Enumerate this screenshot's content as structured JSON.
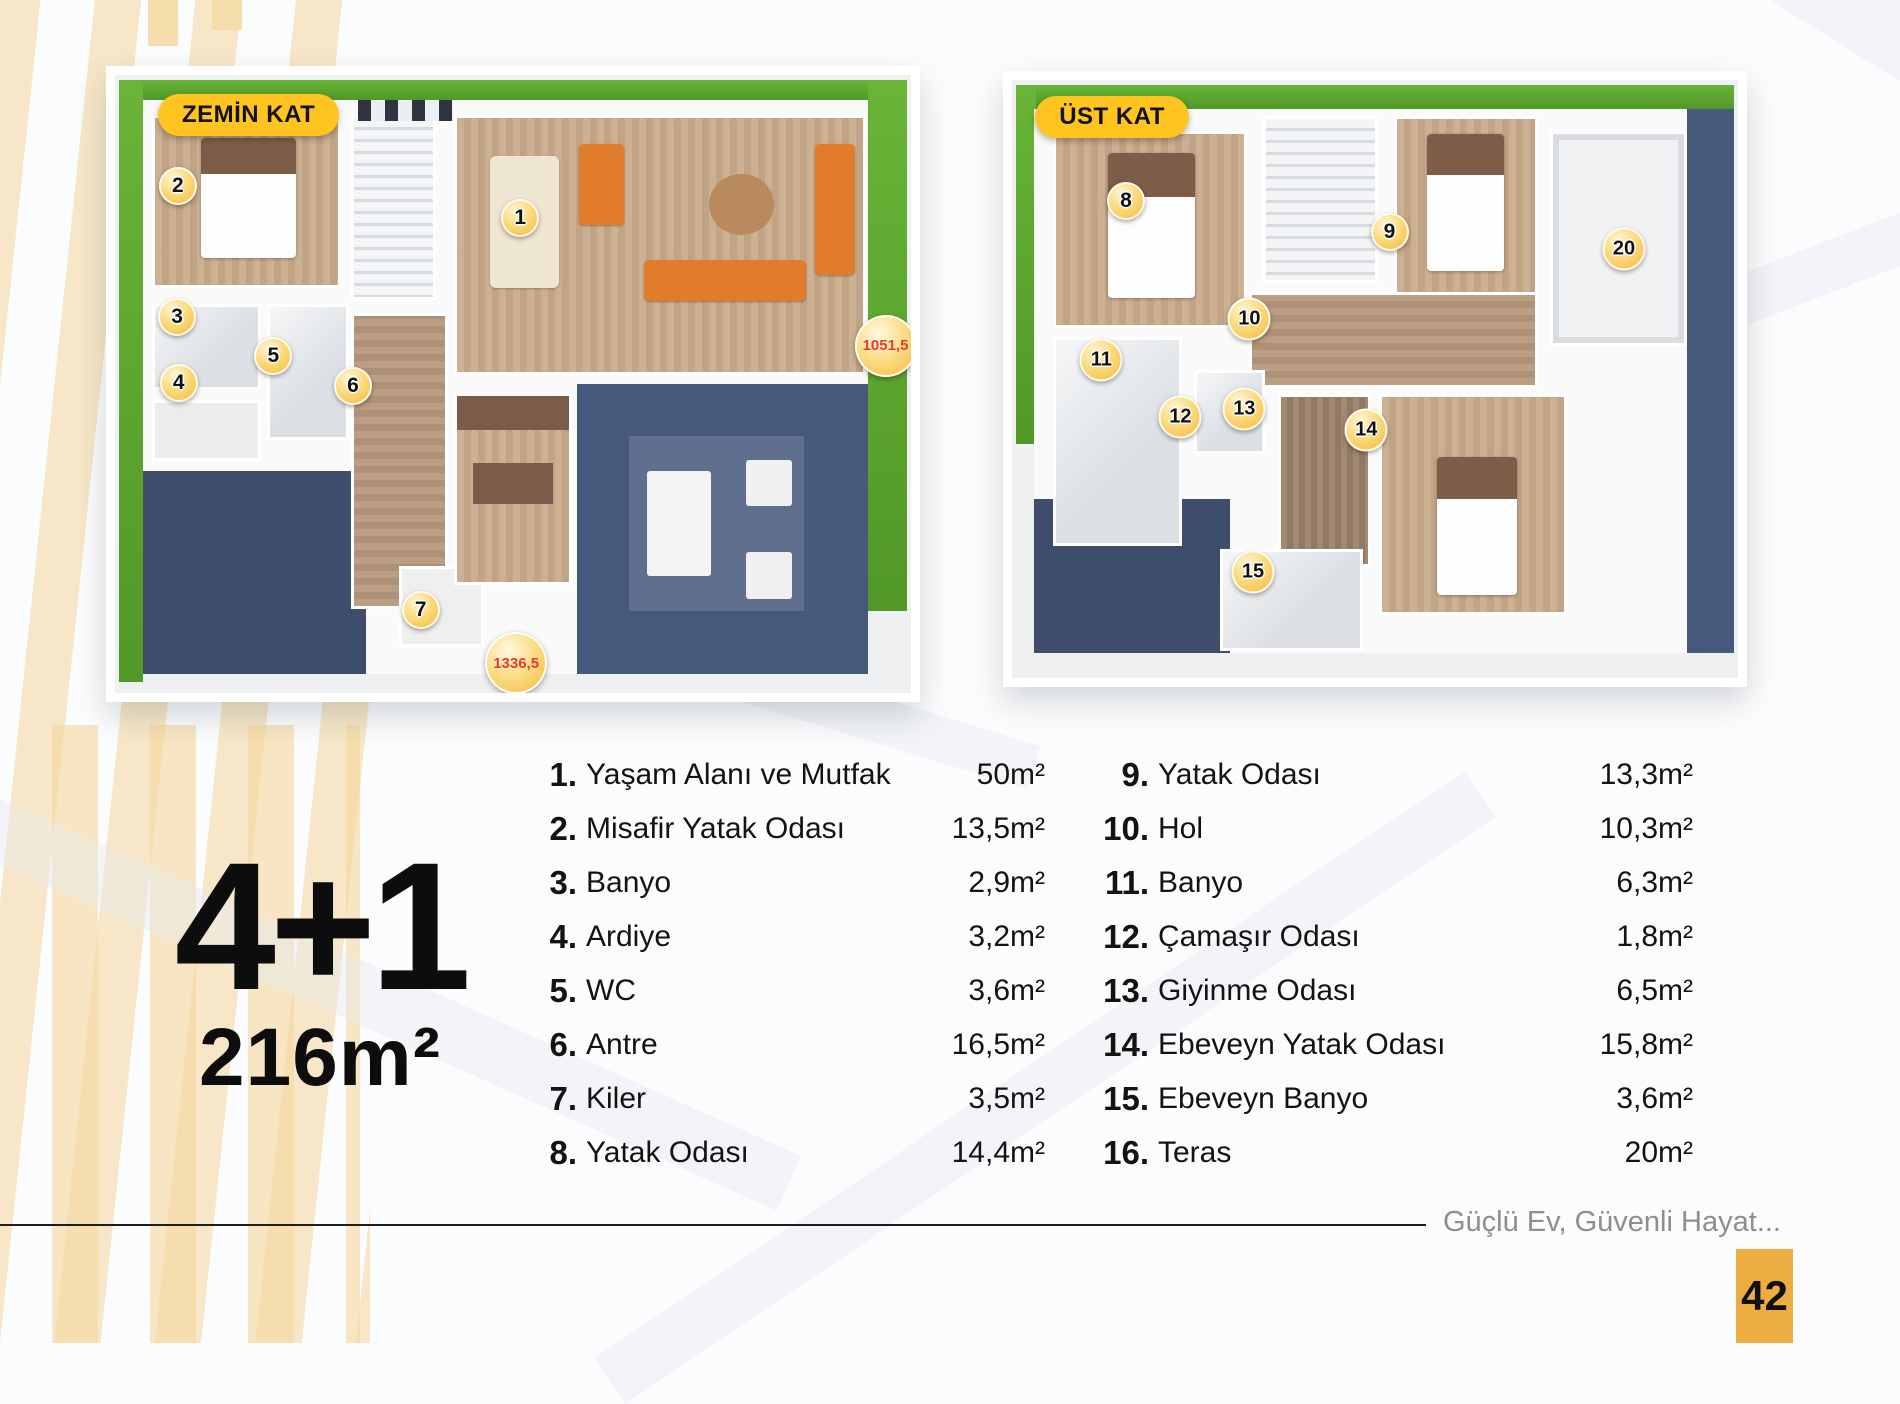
{
  "summary": {
    "configuration": "4+1",
    "total_area": "216m²"
  },
  "plans": [
    {
      "label": "ZEMİN KAT",
      "markers": [
        {
          "n": "1",
          "x": 50.9,
          "y": 23.2
        },
        {
          "n": "2",
          "x": 7.9,
          "y": 17.9
        },
        {
          "n": "3",
          "x": 7.8,
          "y": 39.2
        },
        {
          "n": "4",
          "x": 8.0,
          "y": 49.8
        },
        {
          "n": "5",
          "x": 19.9,
          "y": 45.4
        },
        {
          "n": "6",
          "x": 29.9,
          "y": 50.3
        },
        {
          "n": "7",
          "x": 38.4,
          "y": 86.5
        }
      ],
      "measurements": [
        {
          "value": "1051,5",
          "x": 96.8,
          "y": 43.8
        },
        {
          "value": "1336,5",
          "x": 50.4,
          "y": 95.2
        }
      ]
    },
    {
      "label": "ÜST KAT",
      "markers": [
        {
          "n": "8",
          "x": 15.7,
          "y": 20.2
        },
        {
          "n": "9",
          "x": 52.0,
          "y": 25.4
        },
        {
          "n": "10",
          "x": 32.7,
          "y": 40.0
        },
        {
          "n": "11",
          "x": 12.3,
          "y": 46.9
        },
        {
          "n": "12",
          "x": 23.2,
          "y": 56.4
        },
        {
          "n": "13",
          "x": 32.0,
          "y": 55.1
        },
        {
          "n": "14",
          "x": 48.8,
          "y": 58.5
        },
        {
          "n": "15",
          "x": 33.2,
          "y": 82.3
        },
        {
          "n": "20",
          "x": 84.3,
          "y": 28.2
        }
      ],
      "measurements": []
    }
  ],
  "room_list": {
    "columns": [
      {
        "items": [
          {
            "num": "1.",
            "name": "Yaşam Alanı ve Mutfak",
            "area": "50m²"
          },
          {
            "num": "2.",
            "name": "Misafir Yatak Odası",
            "area": "13,5m²"
          },
          {
            "num": "3.",
            "name": "Banyo",
            "area": "2,9m²"
          },
          {
            "num": "4.",
            "name": "Ardiye",
            "area": "3,2m²"
          },
          {
            "num": "5.",
            "name": "WC",
            "area": "3,6m²"
          },
          {
            "num": "6.",
            "name": "Antre",
            "area": "16,5m²"
          },
          {
            "num": "7.",
            "name": "Kiler",
            "area": "3,5m²"
          },
          {
            "num": "8.",
            "name": "Yatak Odası",
            "area": "14,4m²"
          }
        ]
      },
      {
        "items": [
          {
            "num": "9.",
            "name": "Yatak Odası",
            "area": "13,3m²"
          },
          {
            "num": "10.",
            "name": "Hol",
            "area": "10,3m²"
          },
          {
            "num": "11.",
            "name": "Banyo",
            "area": "6,3m²"
          },
          {
            "num": "12.",
            "name": "Çamaşır Odası",
            "area": "1,8m²"
          },
          {
            "num": "13.",
            "name": "Giyinme Odası",
            "area": "6,5m²"
          },
          {
            "num": "14.",
            "name": "Ebeveyn Yatak Odası",
            "area": "15,8m²"
          },
          {
            "num": "15.",
            "name": "Ebeveyn Banyo",
            "area": "3,6m²"
          },
          {
            "num": "16.",
            "name": "Teras",
            "area": "20m²"
          }
        ]
      }
    ]
  },
  "footer": {
    "slogan": "Güçlü Ev, Güvenli Hayat...",
    "page_number": "42"
  },
  "colors": {
    "accent_yellow": "#ffc41f",
    "badge_gold": "#f0b33f",
    "measure_red": "#e63b36",
    "page_box_amber": "#eead43",
    "lawn_green": "#5ca930",
    "floor_navy": "#46587b"
  }
}
